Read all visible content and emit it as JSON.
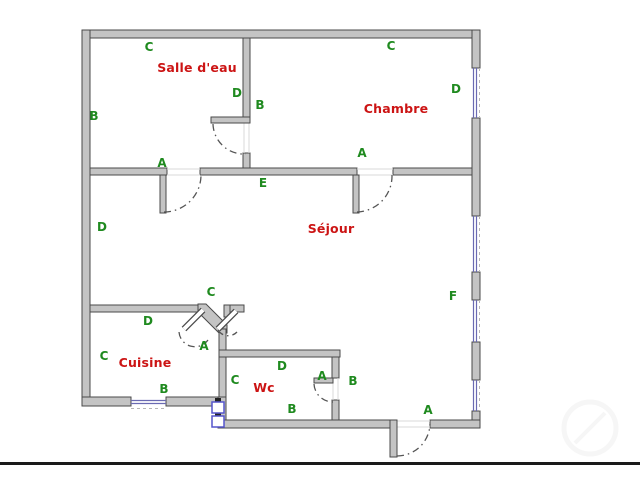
{
  "theme": {
    "background": "#ffffff",
    "wall_fill": "#c4c4c4",
    "wall_outline": "#4a4a4a",
    "window_color": "#6a6ab2",
    "door_arc_color": "#555555",
    "room_label_color": "#cc1414",
    "dimension_label_color": "#1f8a1f",
    "fixture_color": "#5555cc",
    "border_line_color": "#1a1a1a"
  },
  "plan": {
    "rooms": [
      {
        "name": "Salle d'eau"
      },
      {
        "name": "Chambre"
      },
      {
        "name": "Séjour"
      },
      {
        "name": "Cuisine"
      },
      {
        "name": "Wc"
      }
    ],
    "dimension_labels": [
      {
        "text": "C"
      },
      {
        "text": "B"
      },
      {
        "text": "D"
      },
      {
        "text": "B"
      },
      {
        "text": "C"
      },
      {
        "text": "D"
      },
      {
        "text": "A"
      },
      {
        "text": "A"
      },
      {
        "text": "E"
      },
      {
        "text": "D"
      },
      {
        "text": "F"
      },
      {
        "text": "C"
      },
      {
        "text": "A"
      },
      {
        "text": "D"
      },
      {
        "text": "C"
      },
      {
        "text": "B"
      },
      {
        "text": "D"
      },
      {
        "text": "C"
      },
      {
        "text": "A"
      },
      {
        "text": "B"
      },
      {
        "text": "B"
      },
      {
        "text": "A"
      }
    ]
  }
}
